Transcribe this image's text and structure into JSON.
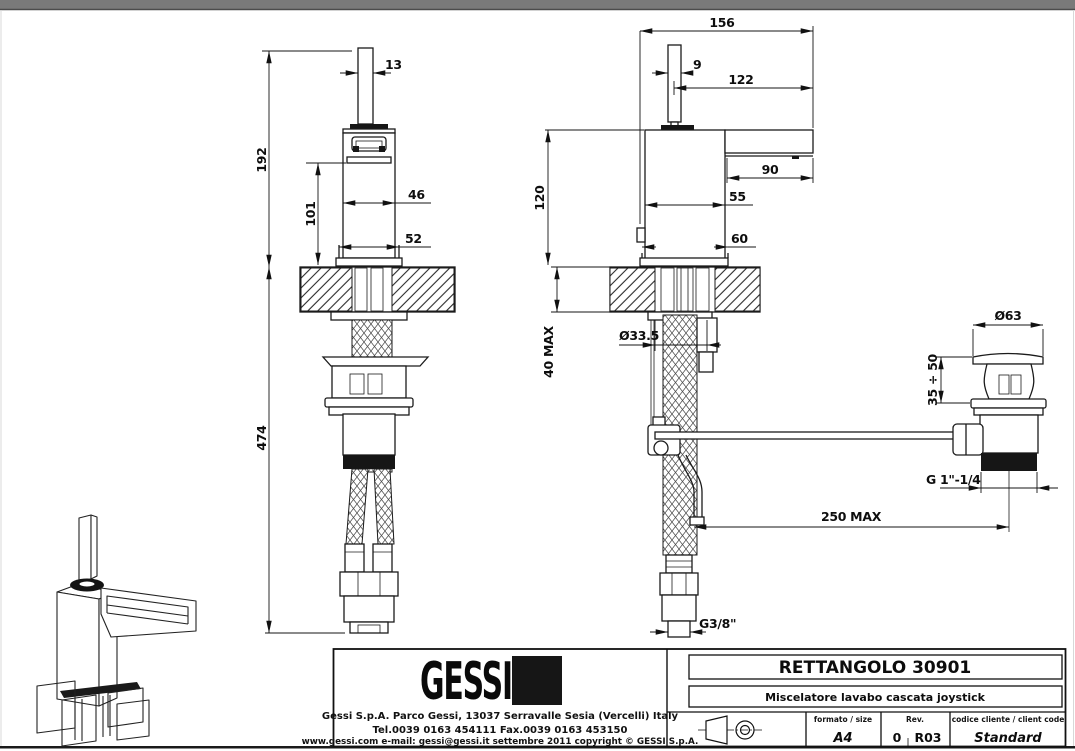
{
  "dims": {
    "front": {
      "handle_width": "13",
      "overall_height": "192",
      "body_height": "101",
      "body_width": "46",
      "base_width": "52",
      "under_counter_height": "474"
    },
    "side": {
      "overall_depth": "156",
      "handle_depth": "9",
      "handle_to_tip": "122",
      "height_above_counter": "120",
      "spout_projection": "90",
      "body_depth": "55",
      "base_depth": "60",
      "counter_thickness": "40 MAX",
      "hole_diameter": "Ø33.5",
      "hose_reach": "250 MAX",
      "supply_thread": "G3/8\""
    },
    "drain": {
      "flange_diameter": "Ø63",
      "adjust_range": "35 ÷ 50",
      "drain_thread": "G 1\"-1/4"
    }
  },
  "title_block": {
    "logo_text": "GESSI",
    "address_line": "Gessi S.p.A. Parco Gessi, 13037 Serravalle Sesia (Vercelli) Italy",
    "phone_line": "Tel.0039 0163 454111 Fax.0039 0163 453150",
    "web_line": "www.gessi.com e-mail: gessi@gessi.it settembre 2011 copyright © GESSI S.p.A.",
    "product_title": "RETTANGOLO 30901",
    "product_subtitle": "Miscelatore lavabo cascata joystick",
    "format_label": "formato / size",
    "format_value": "A4",
    "rev_label": "Rev.",
    "rev_value": "0",
    "rev_code": "R03",
    "client_label": "codice cliente / client code",
    "client_value": "Standard"
  }
}
